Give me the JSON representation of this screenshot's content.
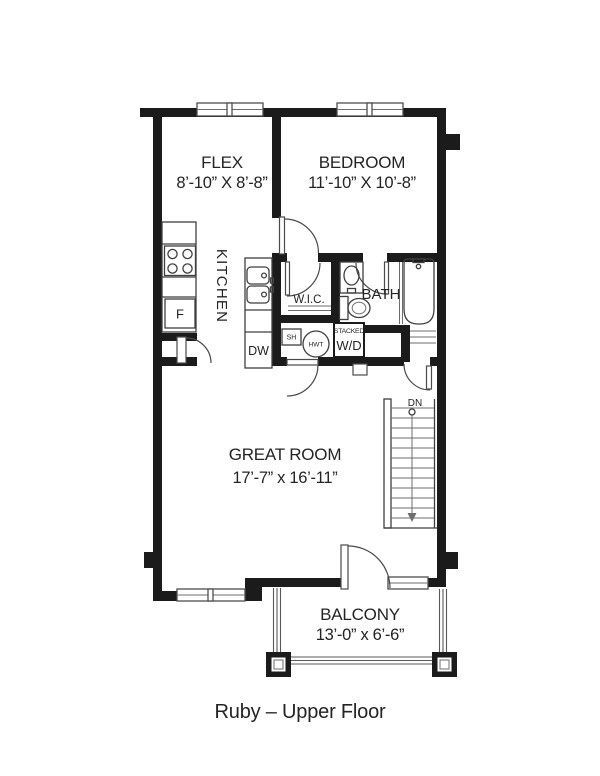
{
  "title": "Ruby – Upper Floor",
  "rooms": {
    "flex": {
      "name": "FLEX",
      "dims": "8’-10” X 8’-8”"
    },
    "bedroom": {
      "name": "BEDROOM",
      "dims": "11’-10” X 10’-8”"
    },
    "kitchen": {
      "name": "KITCHEN"
    },
    "wic": {
      "name": "W.I.C."
    },
    "bath": {
      "name": "BATH"
    },
    "great_room": {
      "name": "GREAT ROOM",
      "dims": "17’-7” x 16’-11”"
    },
    "balcony": {
      "name": "BALCONY",
      "dims": "13’-0” x 6’-6”"
    }
  },
  "fixtures": {
    "fridge": "F",
    "dishwasher": "DW",
    "shelf": "SH",
    "hot_water_tank": "HWT",
    "washer_dryer_line1": "STACKED",
    "washer_dryer_line2": "W/D",
    "stairs_dn": "DN"
  },
  "colors": {
    "wall": "#1b1b1b",
    "line": "#3f3f3f",
    "background": "#ffffff"
  }
}
